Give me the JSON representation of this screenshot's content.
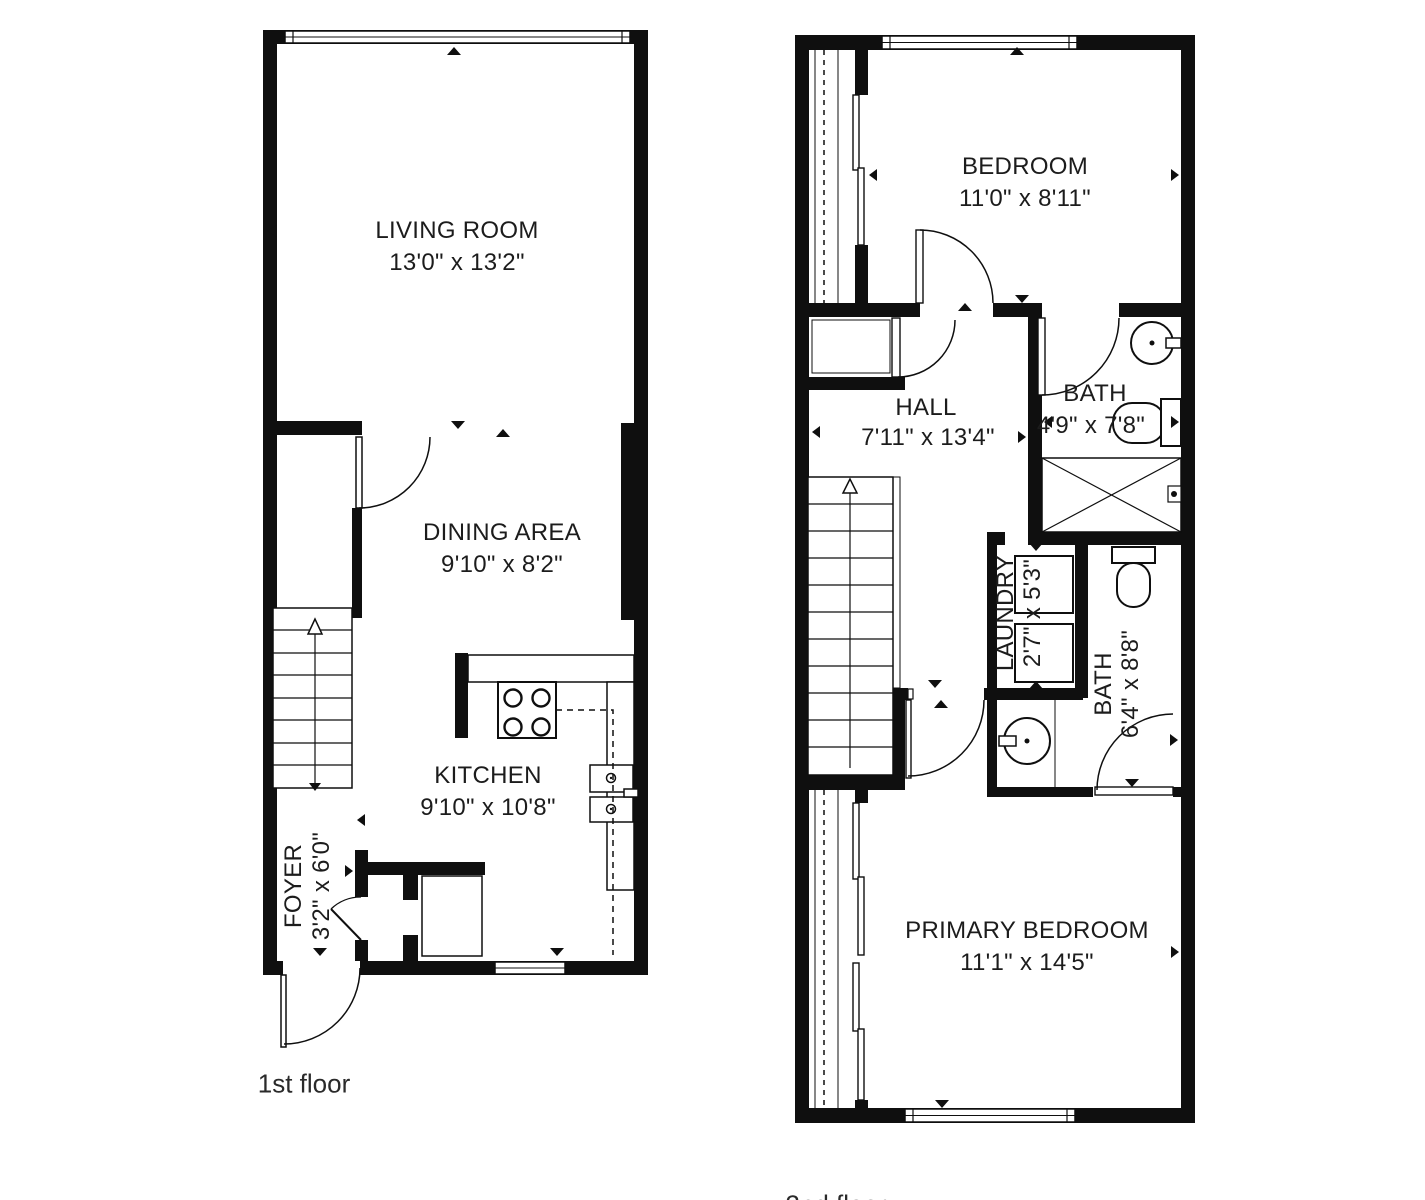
{
  "title": "Two-story townhouse floor plan",
  "colors": {
    "wall": "#0f0f0f",
    "background": "#ffffff",
    "text": "#1c1c1c"
  },
  "floor1": {
    "label": "1st floor",
    "rooms": {
      "living": {
        "name": "LIVING ROOM",
        "dims": "13'0\" x 13'2\""
      },
      "dining": {
        "name": "DINING AREA",
        "dims": "9'10\" x 8'2\""
      },
      "kitchen": {
        "name": "KITCHEN",
        "dims": "9'10\" x 10'8\""
      },
      "foyer": {
        "name": "FOYER",
        "dims": "3'2\" x 6'0\""
      }
    }
  },
  "floor2": {
    "label": "2nd floor",
    "rooms": {
      "bedroom": {
        "name": "BEDROOM",
        "dims": "11'0\" x 8'11\""
      },
      "hall": {
        "name": "HALL",
        "dims": "7'11\" x 13'4\""
      },
      "bath_upper": {
        "name": "BATH",
        "dims": "4'9\" x 7'8\""
      },
      "laundry": {
        "name": "LAUNDRY",
        "dims": "2'7\" x 5'3\""
      },
      "bath_lower": {
        "name": "BATH",
        "dims": "6'4\" x 8'8\""
      },
      "primary": {
        "name": "PRIMARY BEDROOM",
        "dims": "11'1\" x 14'5\""
      }
    }
  }
}
